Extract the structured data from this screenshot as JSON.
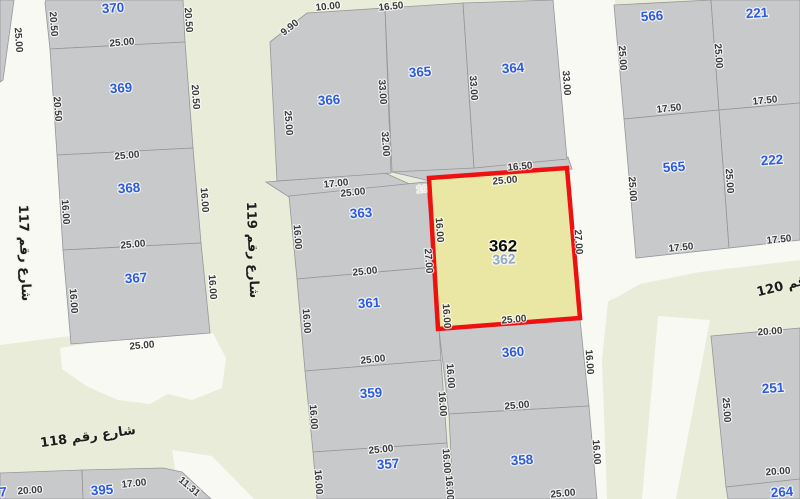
{
  "map": {
    "colors": {
      "street_green": "#e9ecd9",
      "street_white": "#f8f9f3",
      "parcel_fill": "#c8c9cb",
      "parcel_stroke": "#95969a",
      "highlight_fill": "#eae7a4",
      "highlight_stroke": "#ee1111",
      "parcel_number": "#2d5be0",
      "dim_text": "#3a3a3a",
      "dim_text_light": "#e5e4da",
      "street_text": "#1c1c1c",
      "highlight_number": "#0d0d0d",
      "highlight_number_faded": "#8fa8cb"
    },
    "selected_parcel": {
      "number": "362",
      "pts": [
        [
          429,
          178
        ],
        [
          567,
          168
        ],
        [
          580,
          318
        ],
        [
          438,
          329
        ]
      ],
      "label": {
        "x": 503,
        "y": 246
      },
      "sub_label": {
        "x": 504,
        "y": 259
      }
    },
    "streets_white": [
      {
        "name": "street-117",
        "pts": [
          [
            13,
            0
          ],
          [
            46,
            0
          ],
          [
            70,
            336
          ],
          [
            0,
            345
          ],
          [
            0,
            82
          ]
        ]
      },
      {
        "name": "street-junction-118-119",
        "pts": [
          [
            60,
            348
          ],
          [
            110,
            340
          ],
          [
            213,
            333
          ],
          [
            226,
            358
          ],
          [
            222,
            388
          ],
          [
            192,
            400
          ],
          [
            168,
            394
          ],
          [
            150,
            404
          ],
          [
            118,
            400
          ],
          [
            88,
            387
          ],
          [
            62,
            369
          ]
        ]
      },
      {
        "name": "street-right-north-south",
        "pts": [
          [
            553,
            0
          ],
          [
            615,
            0
          ],
          [
            625,
            118
          ],
          [
            636,
            256
          ],
          [
            640,
            275
          ],
          [
            608,
            302
          ],
          [
            602,
            360
          ],
          [
            607,
            499
          ],
          [
            596,
            499
          ],
          [
            589,
            406
          ],
          [
            580,
            319
          ],
          [
            567,
            169
          ],
          [
            567,
            159
          ]
        ]
      },
      {
        "name": "street-under-565",
        "pts": [
          [
            636,
            256
          ],
          [
            729,
            248
          ],
          [
            800,
            241
          ],
          [
            800,
            260
          ],
          [
            700,
            272
          ],
          [
            640,
            284
          ],
          [
            612,
            300
          ]
        ]
      },
      {
        "name": "street-branch-southeast",
        "pts": [
          [
            658,
            316
          ],
          [
            710,
            320
          ],
          [
            676,
            499
          ],
          [
            642,
            499
          ]
        ]
      },
      {
        "name": "street-band-southwest",
        "pts": [
          [
            172,
            450
          ],
          [
            212,
            456
          ],
          [
            254,
            499
          ],
          [
            180,
            499
          ]
        ]
      }
    ],
    "filler_blocks": [
      {
        "pts": [
          [
            266,
            182
          ],
          [
            385,
            173
          ],
          [
            414,
            186
          ],
          [
            289,
            197
          ]
        ]
      },
      {
        "pts": [
          [
            392,
            172
          ],
          [
            568,
            157
          ],
          [
            572,
            169
          ],
          [
            430,
            181
          ]
        ]
      }
    ],
    "parcels": [
      {
        "number": "370",
        "pts": [
          [
            46,
            0
          ],
          [
            183,
            0
          ],
          [
            185,
            42
          ],
          [
            50,
            49
          ],
          [
            45,
            3
          ]
        ],
        "lx": 113,
        "ly": 8
      },
      {
        "number": "369",
        "pts": [
          [
            50,
            49
          ],
          [
            185,
            42
          ],
          [
            193,
            148
          ],
          [
            57,
            155
          ]
        ],
        "lx": 121,
        "ly": 88
      },
      {
        "number": "368",
        "pts": [
          [
            57,
            155
          ],
          [
            193,
            148
          ],
          [
            201,
            243
          ],
          [
            63,
            250
          ]
        ],
        "lx": 129,
        "ly": 188
      },
      {
        "number": "367",
        "pts": [
          [
            63,
            250
          ],
          [
            201,
            243
          ],
          [
            210,
            333
          ],
          [
            71,
            344
          ]
        ],
        "lx": 136,
        "ly": 278
      },
      {
        "number": "366",
        "pts": [
          [
            270,
            42
          ],
          [
            307,
            13
          ],
          [
            385,
            8
          ],
          [
            391,
            173
          ],
          [
            277,
            181
          ]
        ],
        "lx": 329,
        "ly": 100
      },
      {
        "number": "365",
        "pts": [
          [
            385,
            8
          ],
          [
            463,
            3
          ],
          [
            474,
            168
          ],
          [
            392,
            172
          ]
        ],
        "lx": 420,
        "ly": 72
      },
      {
        "number": "364",
        "pts": [
          [
            463,
            3
          ],
          [
            553,
            0
          ],
          [
            567,
            159
          ],
          [
            474,
            168
          ]
        ],
        "lx": 513,
        "ly": 68
      },
      {
        "number": "363",
        "pts": [
          [
            289,
            196
          ],
          [
            426,
            182
          ],
          [
            435,
            267
          ],
          [
            297,
            279
          ]
        ],
        "lx": 361,
        "ly": 213
      },
      {
        "number": "361",
        "pts": [
          [
            297,
            279
          ],
          [
            435,
            267
          ],
          [
            441,
            360
          ],
          [
            305,
            371
          ]
        ],
        "lx": 369,
        "ly": 303
      },
      {
        "number": "359",
        "pts": [
          [
            305,
            371
          ],
          [
            441,
            360
          ],
          [
            447,
            443
          ],
          [
            313,
            452
          ]
        ],
        "lx": 371,
        "ly": 393
      },
      {
        "number": "357",
        "pts": [
          [
            313,
            452
          ],
          [
            447,
            443
          ],
          [
            452,
            499
          ],
          [
            317,
            499
          ]
        ],
        "lx": 388,
        "ly": 464
      },
      {
        "number": "360",
        "pts": [
          [
            439,
            330
          ],
          [
            580,
            319
          ],
          [
            589,
            406
          ],
          [
            449,
            414
          ]
        ],
        "lx": 513,
        "ly": 352
      },
      {
        "number": "358",
        "pts": [
          [
            449,
            414
          ],
          [
            589,
            406
          ],
          [
            597,
            499
          ],
          [
            453,
            499
          ]
        ],
        "lx": 522,
        "ly": 460
      },
      {
        "number": "566",
        "pts": [
          [
            614,
            5
          ],
          [
            711,
            0
          ],
          [
            719,
            110
          ],
          [
            624,
            119
          ]
        ],
        "lx": 652,
        "ly": 16
      },
      {
        "number": "221",
        "pts": [
          [
            711,
            0
          ],
          [
            800,
            0
          ],
          [
            800,
            103
          ],
          [
            719,
            110
          ]
        ],
        "lx": 757,
        "ly": 13
      },
      {
        "number": "565",
        "pts": [
          [
            624,
            119
          ],
          [
            719,
            110
          ],
          [
            729,
            248
          ],
          [
            636,
            258
          ]
        ],
        "lx": 674,
        "ly": 167
      },
      {
        "number": "222",
        "pts": [
          [
            719,
            110
          ],
          [
            800,
            103
          ],
          [
            800,
            240
          ],
          [
            729,
            248
          ]
        ],
        "lx": 772,
        "ly": 160
      },
      {
        "number": "251",
        "pts": [
          [
            711,
            336
          ],
          [
            800,
            328
          ],
          [
            800,
            479
          ],
          [
            726,
            487
          ]
        ],
        "lx": 773,
        "ly": 388
      },
      {
        "number": "264",
        "pts": [
          [
            726,
            487
          ],
          [
            800,
            479
          ],
          [
            800,
            499
          ],
          [
            728,
            499
          ]
        ],
        "lx": 782,
        "ly": 492
      },
      {
        "number": "7",
        "pts": [
          [
            0,
            473
          ],
          [
            82,
            470
          ],
          [
            83,
            499
          ],
          [
            0,
            499
          ]
        ],
        "lx": 3,
        "ly": 492
      },
      {
        "number": "395",
        "pts": [
          [
            82,
            470
          ],
          [
            163,
            468
          ],
          [
            182,
            472
          ],
          [
            211,
            499
          ],
          [
            83,
            499
          ]
        ],
        "lx": 102,
        "ly": 490
      },
      {
        "number": "",
        "pts": [
          [
            0,
            0
          ],
          [
            14,
            0
          ],
          [
            3,
            80
          ],
          [
            0,
            82
          ]
        ],
        "lx": 0,
        "ly": 0
      }
    ],
    "dims_under_highlight": [
      {
        "t": "16.50",
        "x": 429,
        "y": 189,
        "r": -6
      }
    ],
    "dims": [
      {
        "t": "25.00",
        "x": 18,
        "y": 40,
        "r": 86
      },
      {
        "t": "20.50",
        "x": 53,
        "y": 24,
        "r": 86
      },
      {
        "t": "20.50",
        "x": 188,
        "y": 20,
        "r": 86
      },
      {
        "t": "25.00",
        "x": 122,
        "y": 43,
        "r": -5
      },
      {
        "t": "20.50",
        "x": 57,
        "y": 109,
        "r": 86
      },
      {
        "t": "20.50",
        "x": 195,
        "y": 97,
        "r": 86
      },
      {
        "t": "25.00",
        "x": 127,
        "y": 156,
        "r": -5
      },
      {
        "t": "16.00",
        "x": 65,
        "y": 212,
        "r": 86
      },
      {
        "t": "16.00",
        "x": 204,
        "y": 200,
        "r": 86
      },
      {
        "t": "25.00",
        "x": 133,
        "y": 245,
        "r": -5
      },
      {
        "t": "16.00",
        "x": 73,
        "y": 301,
        "r": 86
      },
      {
        "t": "16.00",
        "x": 212,
        "y": 287,
        "r": 86
      },
      {
        "t": "25.00",
        "x": 142,
        "y": 346,
        "r": -5
      },
      {
        "t": "9.90",
        "x": 290,
        "y": 28,
        "r": -38
      },
      {
        "t": "10.00",
        "x": 328,
        "y": 7,
        "r": -6
      },
      {
        "t": "16.50",
        "x": 391,
        "y": 7,
        "r": -6
      },
      {
        "t": "25.00",
        "x": 288,
        "y": 123,
        "r": 86
      },
      {
        "t": "33.00",
        "x": 382,
        "y": 92,
        "r": 86
      },
      {
        "t": "32.00",
        "x": 385,
        "y": 144,
        "r": 86
      },
      {
        "t": "33.00",
        "x": 473,
        "y": 88,
        "r": 86
      },
      {
        "t": "33.00",
        "x": 566,
        "y": 83,
        "r": 86
      },
      {
        "t": "16.50",
        "x": 520,
        "y": 167,
        "r": -5
      },
      {
        "t": "25.00",
        "x": 622,
        "y": 58,
        "r": 86
      },
      {
        "t": "25.00",
        "x": 718,
        "y": 56,
        "r": 86
      },
      {
        "t": "17.50",
        "x": 669,
        "y": 109,
        "r": -6
      },
      {
        "t": "17.50",
        "x": 765,
        "y": 101,
        "r": -6
      },
      {
        "t": "25.00",
        "x": 632,
        "y": 189,
        "r": 86
      },
      {
        "t": "25.00",
        "x": 729,
        "y": 181,
        "r": 86
      },
      {
        "t": "17.50",
        "x": 681,
        "y": 248,
        "r": -6
      },
      {
        "t": "17.50",
        "x": 779,
        "y": 240,
        "r": -6
      },
      {
        "t": "17.00",
        "x": 336,
        "y": 184,
        "r": -6
      },
      {
        "t": "25.00",
        "x": 353,
        "y": 193,
        "r": -6
      },
      {
        "t": "16.00",
        "x": 297,
        "y": 237,
        "r": 86
      },
      {
        "t": "25.00",
        "x": 505,
        "y": 181,
        "r": -5
      },
      {
        "t": "16.00",
        "x": 439,
        "y": 230,
        "r": 86
      },
      {
        "t": "27.00",
        "x": 428,
        "y": 261,
        "r": 86
      },
      {
        "t": "27.00",
        "x": 578,
        "y": 242,
        "r": 86
      },
      {
        "t": "16.00",
        "x": 446,
        "y": 316,
        "r": 86
      },
      {
        "t": "25.00",
        "x": 514,
        "y": 320,
        "r": -5
      },
      {
        "t": "25.00",
        "x": 365,
        "y": 272,
        "r": -6
      },
      {
        "t": "16.00",
        "x": 306,
        "y": 321,
        "r": 86
      },
      {
        "t": "25.00",
        "x": 373,
        "y": 360,
        "r": -6
      },
      {
        "t": "16.00",
        "x": 313,
        "y": 417,
        "r": 86
      },
      {
        "t": "16.00",
        "x": 450,
        "y": 376,
        "r": 86
      },
      {
        "t": "16.00",
        "x": 442,
        "y": 404,
        "r": 86
      },
      {
        "t": "25.00",
        "x": 381,
        "y": 450,
        "r": -6
      },
      {
        "t": "16.00",
        "x": 318,
        "y": 482,
        "r": 86
      },
      {
        "t": "16.00",
        "x": 446,
        "y": 461,
        "r": 86
      },
      {
        "t": "16.00",
        "x": 449,
        "y": 488,
        "r": 86
      },
      {
        "t": "25.00",
        "x": 517,
        "y": 406,
        "r": -5
      },
      {
        "t": "25.00",
        "x": 563,
        "y": 494,
        "r": -5
      },
      {
        "t": "16.00",
        "x": 589,
        "y": 362,
        "r": 86
      },
      {
        "t": "16.00",
        "x": 596,
        "y": 452,
        "r": 86
      },
      {
        "t": "20.00",
        "x": 30,
        "y": 491,
        "r": -4
      },
      {
        "t": "17.00",
        "x": 134,
        "y": 484,
        "r": -6
      },
      {
        "t": "11.31",
        "x": 189,
        "y": 487,
        "r": 40
      },
      {
        "t": "20.00",
        "x": 770,
        "y": 332,
        "r": -4
      },
      {
        "t": "25.00",
        "x": 726,
        "y": 410,
        "r": 86
      },
      {
        "t": "20.00",
        "x": 778,
        "y": 472,
        "r": -4
      }
    ],
    "street_labels": [
      {
        "t": "شارع رقم 117",
        "x": 24,
        "y": 253,
        "r": 88,
        "anchor": "middle"
      },
      {
        "t": "شارع رقم 119",
        "x": 252,
        "y": 250,
        "r": 88,
        "anchor": "middle"
      },
      {
        "t": "شارع رقم 118",
        "x": 88,
        "y": 437,
        "r": -8,
        "anchor": "middle"
      },
      {
        "t": "شارع رقم 120",
        "x": 757,
        "y": 293,
        "r": -14,
        "anchor": "end"
      }
    ]
  }
}
